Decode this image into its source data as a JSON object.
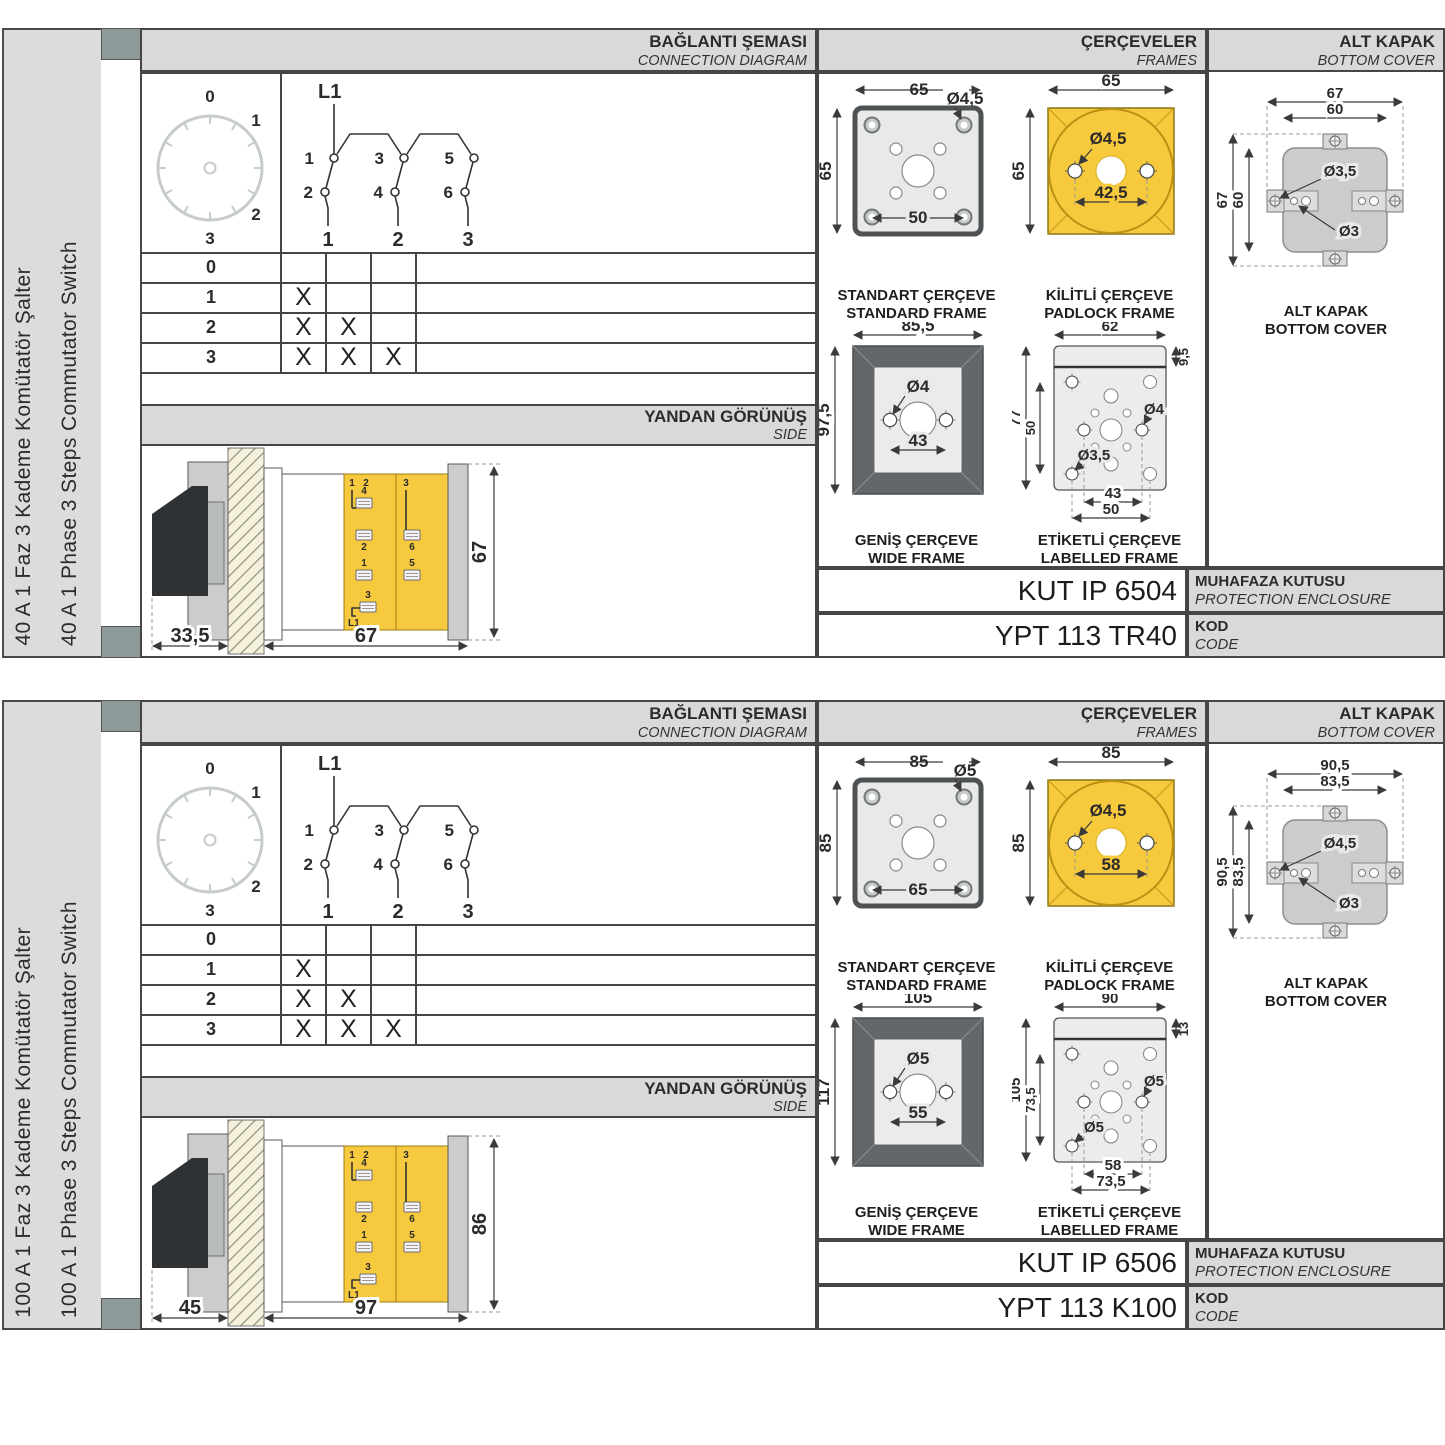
{
  "panels": [
    {
      "sidebar": {
        "label_tr": "40 A 1 Faz 3 Kademe Komütatör Şalter",
        "label_en": "40 A 1 Phase 3 Steps Commutator Switch"
      },
      "headers": {
        "connection": {
          "title": "BAĞLANTI ŞEMASI",
          "subtitle": "CONNECTION DIAGRAM"
        },
        "frames": {
          "title": "ÇERÇEVELER",
          "subtitle": "FRAMES"
        },
        "cover": {
          "title": "ALT KAPAK",
          "subtitle": "BOTTOM COVER"
        }
      },
      "dial": {
        "p0": "0",
        "p1": "1",
        "p2": "2",
        "p3": "3"
      },
      "switch": {
        "feed": "L1",
        "c1": "1",
        "c2": "2",
        "c3": "3",
        "c4": "4",
        "c5": "5",
        "c6": "6",
        "o1": "1",
        "o2": "2",
        "o3": "3"
      },
      "table": {
        "rows": [
          {
            "label": "0",
            "m1": "",
            "m2": "",
            "m3": ""
          },
          {
            "label": "1",
            "m1": "X",
            "m2": "",
            "m3": ""
          },
          {
            "label": "2",
            "m1": "X",
            "m2": "X",
            "m3": ""
          },
          {
            "label": "3",
            "m1": "X",
            "m2": "X",
            "m3": "X"
          }
        ]
      },
      "side": {
        "title": "YANDAN GÖRÜNÜŞ",
        "subtitle": "SIDE",
        "dim_handle": "33,5",
        "dim_body": "67",
        "dim_height": "67",
        "t_top1": "1",
        "t_top2": "2",
        "t_top3": "3",
        "t_a": "4",
        "t_b": "2",
        "t_c": "6",
        "t_d": "1",
        "t_e": "5",
        "t_f": "3",
        "t_feed": "L1"
      },
      "standard": {
        "cap_tr": "STANDART ÇERÇEVE",
        "cap_en": "STANDARD FRAME",
        "w": "65",
        "h": "65",
        "hole": "Ø4,5",
        "inner": "50"
      },
      "padlock": {
        "cap_tr": "KİLİTLİ ÇERÇEVE",
        "cap_en": "PADLOCK FRAME",
        "w": "65",
        "h": "65",
        "hole": "Ø4,5",
        "span": "42,5"
      },
      "wide": {
        "cap_tr": "GENİŞ ÇERÇEVE",
        "cap_en": "WIDE FRAME",
        "w": "85,5",
        "h": "97,5",
        "hole": "Ø4",
        "span": "43"
      },
      "labelled": {
        "cap_tr": "ETİKETLİ ÇERÇEVE",
        "cap_en": "LABELLED FRAME",
        "w": "62",
        "strip": "9,5",
        "h": "77",
        "inner_h": "50",
        "hole_r": "Ø4",
        "hole_l": "Ø3,5",
        "span_in": "43",
        "span_out": "50"
      },
      "cover": {
        "cap_tr": "ALT KAPAK",
        "cap_en": "BOTTOM COVER",
        "w_out": "67",
        "w_in": "60",
        "h_out": "67",
        "h_in": "60",
        "hole_tab": "Ø3,5",
        "hole_in": "Ø3"
      },
      "codes": {
        "enclosure_value": "KUT IP 6504",
        "enclosure_tr": "MUHAFAZA KUTUSU",
        "enclosure_en": "PROTECTION ENCLOSURE",
        "code_value": "YPT 113 TR40",
        "code_tr": "KOD",
        "code_en": "CODE"
      }
    },
    {
      "sidebar": {
        "label_tr": "100 A 1 Faz 3 Kademe Komütatör Şalter",
        "label_en": "100 A 1 Phase 3 Steps Commutator Switch"
      },
      "headers": {
        "connection": {
          "title": "BAĞLANTI ŞEMASI",
          "subtitle": "CONNECTION DIAGRAM"
        },
        "frames": {
          "title": "ÇERÇEVELER",
          "subtitle": "FRAMES"
        },
        "cover": {
          "title": "ALT KAPAK",
          "subtitle": "BOTTOM COVER"
        }
      },
      "dial": {
        "p0": "0",
        "p1": "1",
        "p2": "2",
        "p3": "3"
      },
      "switch": {
        "feed": "L1",
        "c1": "1",
        "c2": "2",
        "c3": "3",
        "c4": "4",
        "c5": "5",
        "c6": "6",
        "o1": "1",
        "o2": "2",
        "o3": "3"
      },
      "table": {
        "rows": [
          {
            "label": "0",
            "m1": "",
            "m2": "",
            "m3": ""
          },
          {
            "label": "1",
            "m1": "X",
            "m2": "",
            "m3": ""
          },
          {
            "label": "2",
            "m1": "X",
            "m2": "X",
            "m3": ""
          },
          {
            "label": "3",
            "m1": "X",
            "m2": "X",
            "m3": "X"
          }
        ]
      },
      "side": {
        "title": "YANDAN GÖRÜNÜŞ",
        "subtitle": "SIDE",
        "dim_handle": "45",
        "dim_body": "97",
        "dim_height": "86",
        "t_top1": "1",
        "t_top2": "2",
        "t_top3": "3",
        "t_a": "4",
        "t_b": "2",
        "t_c": "6",
        "t_d": "1",
        "t_e": "5",
        "t_f": "3",
        "t_feed": "L1"
      },
      "standard": {
        "cap_tr": "STANDART ÇERÇEVE",
        "cap_en": "STANDARD FRAME",
        "w": "85",
        "h": "85",
        "hole": "Ø5",
        "inner": "65"
      },
      "padlock": {
        "cap_tr": "KİLİTLİ ÇERÇEVE",
        "cap_en": "PADLOCK FRAME",
        "w": "85",
        "h": "85",
        "hole": "Ø4,5",
        "span": "58"
      },
      "wide": {
        "cap_tr": "GENİŞ ÇERÇEVE",
        "cap_en": "WIDE FRAME",
        "w": "105",
        "h": "117",
        "hole": "Ø5",
        "span": "55"
      },
      "labelled": {
        "cap_tr": "ETİKETLİ ÇERÇEVE",
        "cap_en": "LABELLED FRAME",
        "w": "90",
        "strip": "13",
        "h": "105",
        "inner_h": "73,5",
        "hole_r": "Ø5",
        "hole_l": "Ø5",
        "span_in": "58",
        "span_out": "73,5"
      },
      "cover": {
        "cap_tr": "ALT KAPAK",
        "cap_en": "BOTTOM COVER",
        "w_out": "90,5",
        "w_in": "83,5",
        "h_out": "90,5",
        "h_in": "83,5",
        "hole_tab": "Ø4,5",
        "hole_in": "Ø3"
      },
      "codes": {
        "enclosure_value": "KUT IP 6506",
        "enclosure_tr": "MUHAFAZA KUTUSU",
        "enclosure_en": "PROTECTION ENCLOSURE",
        "code_value": "YPT 113 K100",
        "code_tr": "KOD",
        "code_en": "CODE"
      }
    }
  ]
}
